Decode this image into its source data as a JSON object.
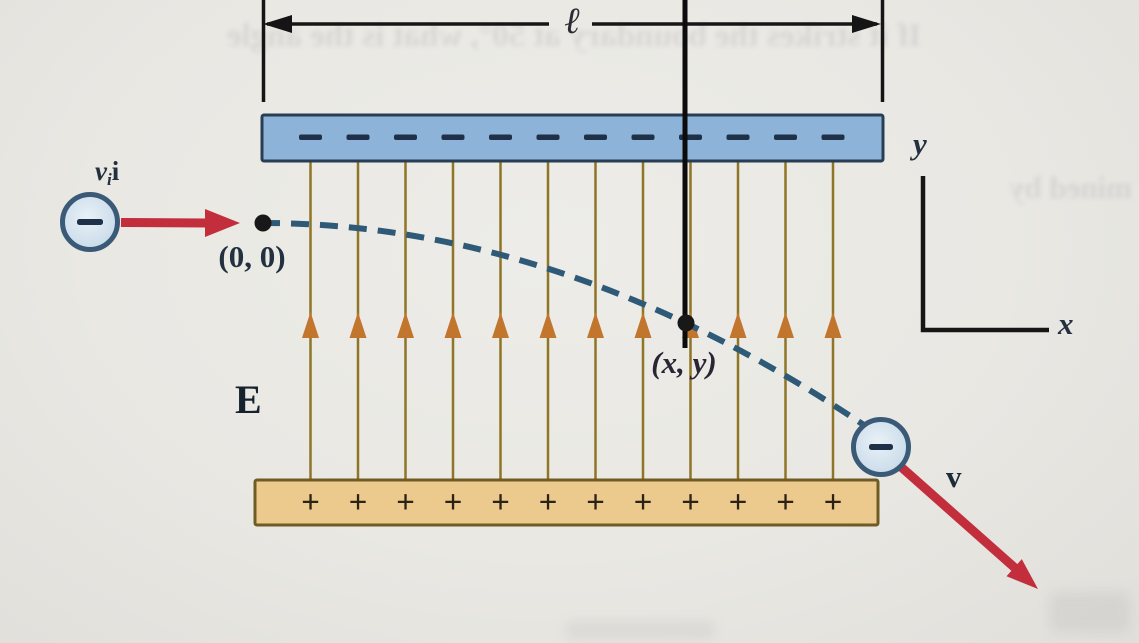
{
  "figure": {
    "type": "physics-diagram",
    "description": "Electron projected horizontally into the uniform electric field between two charged parallel plates, deflected along a parabolic path",
    "caption_labels": {
      "plate_length": "ℓ",
      "initial_velocity_scalar": "v",
      "initial_velocity_subscript": "i",
      "initial_velocity_vector": "i",
      "origin_point": "(0, 0)",
      "deflection_point": "(x, y)",
      "electric_field": "E",
      "y_axis": "y",
      "x_axis": "x",
      "final_velocity": "v"
    },
    "plates": {
      "top": {
        "polarity": "negative",
        "sign": "−",
        "sign_count": 12
      },
      "bottom": {
        "polarity": "positive",
        "sign": "+",
        "sign_count": 12
      }
    },
    "field": {
      "line_count": 12,
      "direction": "up"
    },
    "particles": {
      "entry_charge": "−",
      "exit_charge": "−"
    },
    "colors": {
      "page": "#eae9e4",
      "ink": "#151515",
      "label-ink": "#22303f",
      "plate-top-fill": "#8db3d8",
      "plate-top-stroke": "#293e54",
      "plate-bottom-fill": "#ecca8d",
      "plate-bottom-stroke": "#6f5b24",
      "field-line": "#8f7526",
      "field-arrow": "#c2752c",
      "trajectory": "#2e5a78",
      "velocity-arrow": "#c22e3c",
      "electron-fill": "#c6d9e8",
      "electron-hi": "#e9f1f7",
      "electron-edge": "#3a5a78",
      "sign-minus": "#1e3148",
      "sign-plus": "#2b2114"
    },
    "ghost_text": {
      "top": "If it strikes the boundary at 50°, what is the angle",
      "right": "mined by"
    }
  }
}
